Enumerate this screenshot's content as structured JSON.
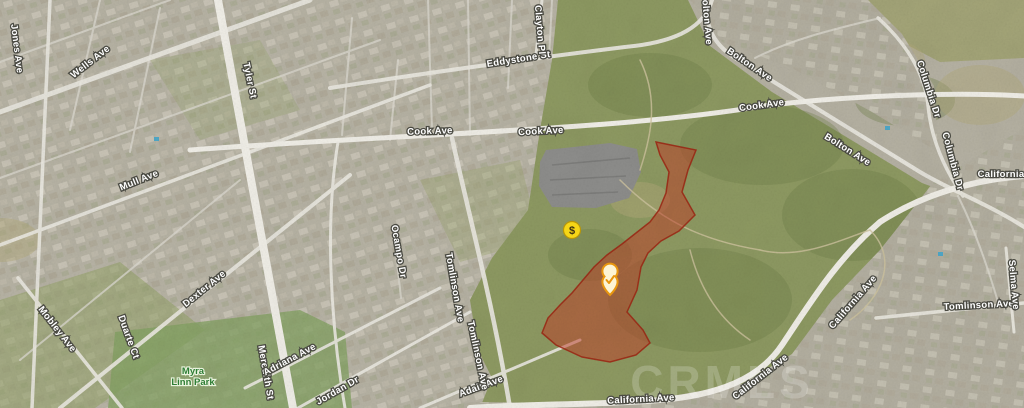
{
  "map": {
    "kind": "satellite-map",
    "watermark": "CRMLS",
    "colors": {
      "parcel_fill": "#c23a24",
      "parcel_stroke": "#9e2412",
      "price_marker_fill": "#f6d617",
      "pin_stroke": "#e8960f",
      "pin_fill": "#fdf4d4",
      "road_label_fill": "#ffffff",
      "park_label_fill": "#2f7d35",
      "hills": "#8e9a62",
      "urban": "#b6b2a3"
    },
    "parcel": {
      "name": "highlighted-parcel",
      "points": "656,142 696,150 688,170 682,192 695,215 679,231 661,241 648,253 641,267 637,290 627,312 643,330 650,343 636,355 610,362 582,357 556,345 542,333 548,318 560,305 572,293 583,280 594,267 607,255 622,244 636,233 650,222 659,210 666,193 669,172 660,155"
    },
    "markers": [
      {
        "id": "price-marker",
        "type": "price",
        "symbol": "$",
        "x": 572,
        "y": 230
      },
      {
        "id": "selected-listing-pin",
        "type": "check-pin",
        "symbol": "check",
        "x": 610,
        "y": 284
      }
    ],
    "street_labels": [
      {
        "text": "Wells Ave",
        "x": 92,
        "y": 64,
        "rot": -38
      },
      {
        "text": "Tyler St",
        "x": 247,
        "y": 81,
        "rot": 78
      },
      {
        "text": "Jones Ave",
        "x": 14,
        "y": 49,
        "rot": 83
      },
      {
        "text": "Mull Ave",
        "x": 140,
        "y": 183,
        "rot": -22
      },
      {
        "text": "Dexter Ave",
        "x": 206,
        "y": 291,
        "rot": -39
      },
      {
        "text": "Mobley Ave",
        "x": 55,
        "y": 331,
        "rot": 52
      },
      {
        "text": "Duarte Ct",
        "x": 126,
        "y": 338,
        "rot": 70
      },
      {
        "text": "Meredith St",
        "x": 263,
        "y": 373,
        "rot": 80
      },
      {
        "text": "Adriana Ave",
        "x": 291,
        "y": 362,
        "rot": -28
      },
      {
        "text": "Jordan Dr",
        "x": 339,
        "y": 393,
        "rot": -30
      },
      {
        "text": "Adair Ave",
        "x": 482,
        "y": 389,
        "rot": -20
      },
      {
        "text": "Ocampo Dr",
        "x": 396,
        "y": 252,
        "rot": 80
      },
      {
        "text": "Tomlinson Ave",
        "x": 452,
        "y": 288,
        "rot": 80
      },
      {
        "text": "Tomlinson Ave",
        "x": 475,
        "y": 356,
        "rot": 78
      },
      {
        "text": "Eddystone St",
        "x": 519,
        "y": 62,
        "rot": -9
      },
      {
        "text": "Clayton Pl",
        "x": 537,
        "y": 30,
        "rot": 85
      },
      {
        "text": "Cook Ave",
        "x": 430,
        "y": 134,
        "rot": -2
      },
      {
        "text": "Cook Ave",
        "x": 541,
        "y": 134,
        "rot": -3
      },
      {
        "text": "Cook Ave",
        "x": 762,
        "y": 108,
        "rot": -8
      },
      {
        "text": "Bolton Ave",
        "x": 704,
        "y": 19,
        "rot": 85
      },
      {
        "text": "Bolton Ave",
        "x": 748,
        "y": 67,
        "rot": 34
      },
      {
        "text": "Bolton Ave",
        "x": 846,
        "y": 152,
        "rot": 32
      },
      {
        "text": "Columbia Dr",
        "x": 926,
        "y": 90,
        "rot": 72
      },
      {
        "text": "Columbia Dr",
        "x": 950,
        "y": 162,
        "rot": 75
      },
      {
        "text": "California",
        "x": 1001,
        "y": 177,
        "rot": 0
      },
      {
        "text": "California Ave",
        "x": 855,
        "y": 304,
        "rot": -49
      },
      {
        "text": "California Ave",
        "x": 762,
        "y": 379,
        "rot": -38
      },
      {
        "text": "California Ave",
        "x": 641,
        "y": 402,
        "rot": -3
      },
      {
        "text": "Tomlinson Ave",
        "x": 979,
        "y": 308,
        "rot": -3
      },
      {
        "text": "Selma Ave",
        "x": 1011,
        "y": 285,
        "rot": 85
      }
    ],
    "park_labels": [
      {
        "text": "Myra",
        "x": 193,
        "y": 374
      },
      {
        "text": "Linn Park",
        "x": 193,
        "y": 385
      }
    ]
  }
}
